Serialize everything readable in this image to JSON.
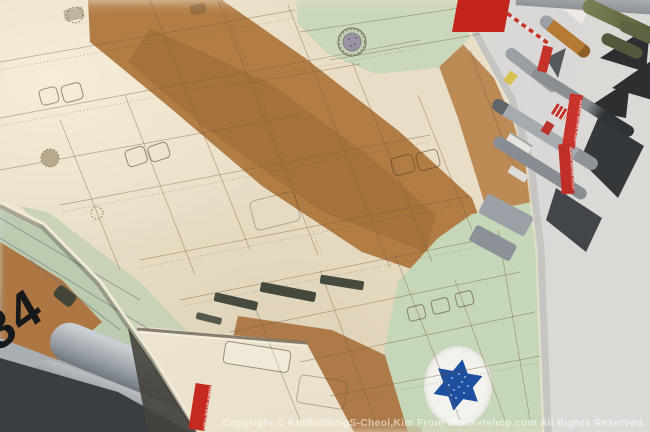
{
  "photo": {
    "subject": "scale model fighter jet wing, top view",
    "watermark": "Copyright © KulBulWingS-Cheol,Kim From iPocketshop.com All Rights Reserved.",
    "tail_number": "34",
    "streamer_label": "REMOVE BEFORE FLIGHT"
  },
  "colors": {
    "camo_tan": "#e9dec5",
    "camo_brown": "#b27c45",
    "camo_green": "#c9d8bc",
    "background_gray": "#d7d5d2",
    "roundel_blue": "#1d4fa1",
    "roundel_white": "#f3f2ee",
    "streamer_red": "#c5322a",
    "tail_number_black": "#17181a"
  }
}
